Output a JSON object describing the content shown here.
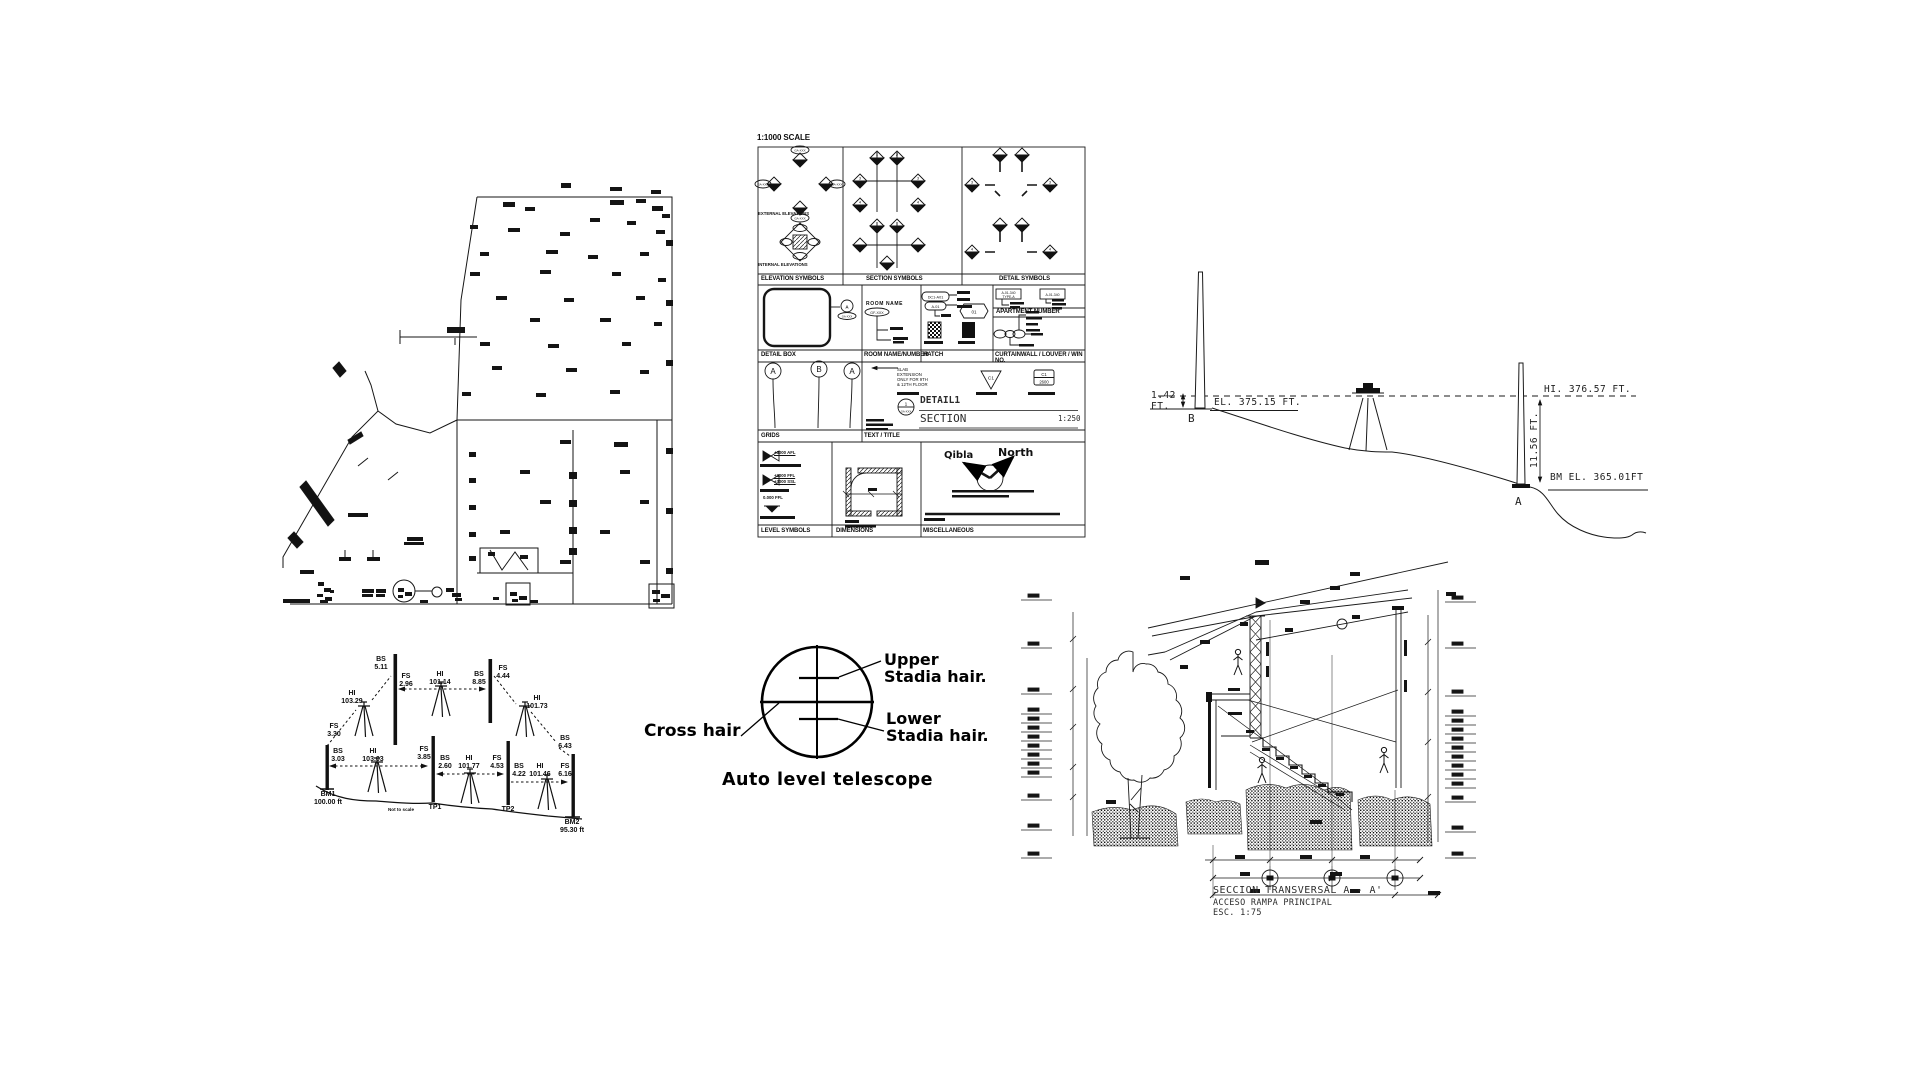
{
  "survey_profile": {
    "reading_b_value": "1.42",
    "reading_b_unit": "FT.",
    "elevation_label": "EL. 375.15 FT.",
    "point_b": "B",
    "hi_label": "HI. 376.57 FT.",
    "reading_a": "11.56 FT.",
    "bm_label": "BM EL. 365.01FT",
    "point_a": "A"
  },
  "leveling": {
    "upper_route": {
      "r1": "FS\n3.30",
      "hi1": "HI\n103.29",
      "r2": "BS\n5.11",
      "r3": "FS\n2.96",
      "hi2": "HI\n101.14",
      "r4": "BS\n8.85",
      "r5": "FS\n4.44",
      "hi3": "HI\n101.73",
      "r6": "BS\n6.43"
    },
    "lower_route": {
      "r1": "BS\n3.03",
      "hi1": "HI\n103.03",
      "r2": "FS\n3.85",
      "r3": "BS\n2.60",
      "hi2": "HI\n101.77",
      "r4": "FS\n4.53",
      "r5": "BS\n4.22",
      "hi3": "HI\n101.46",
      "r6": "FS\n6.16"
    },
    "bm1": "BM1\n100.00 ft",
    "bm2": "BM2\n95.30 ft",
    "tp1": "TP1",
    "tp2": "TP2",
    "note": "Not to scale"
  },
  "telescope": {
    "upper": "Upper\nStadia hair.",
    "cross": "Cross hair",
    "lower": "Lower\nStadia hair.",
    "caption": "Auto level telescope"
  },
  "legend": {
    "title": "1:1000 SCALE",
    "captions": {
      "elevation": "ELEVATION SYMBOLS",
      "section": "SECTION SYMBOLS",
      "detail": "DETAIL SYMBOLS",
      "detail_box": "DETAIL BOX",
      "room": "ROOM NAME/NUMBER",
      "hatch": "HATCH",
      "apartment": "APARTMENT NUMBER",
      "curtainwall": "CURTAINWALL / LOUVER / WIN NO.",
      "grids": "GRIDS",
      "text_title": "TEXT / TITLE",
      "level": "LEVEL SYMBOLS",
      "dimensions": "DIMENSIONS",
      "misc": "MISCELLANEOUS"
    },
    "sub": {
      "external": "EXTERNAL ELEVATIONS",
      "internal": "INTERNAL ELEVATIONS",
      "room_name": "ROOM NAME",
      "room_tag": "GF-XXX",
      "zone_tag1": "DC1-A01",
      "zone_tag2": "A-01",
      "apt_tag": "A-01-340",
      "apt_type": "TYPE-A",
      "hex_tag": "GA-XXX",
      "hex_num": "01",
      "grid_a": "A",
      "grid_b": "B",
      "rev_tag": "C1",
      "cw_tag": "C1",
      "cw_num": "2600",
      "slab_note": "SLAB\nEXTENSION\nONLY FOR 9TH\n& 12TH FLOOR",
      "detail_num": "1",
      "detail_title": "DETAIL1",
      "section_title": "SECTION",
      "scale": "1:250",
      "qibla": "Qibla",
      "north": "North",
      "lvl1": "+3000 AFL",
      "lvl2": "+3000 FFL",
      "lvl3": "+3000 SSL",
      "lvl4": "0.000 FFL",
      "n1": "1",
      "n2": "2",
      "n3": "3",
      "n4": "4"
    }
  },
  "section_drawing": {
    "title": "SECCION TRANSVERSAL A - A'",
    "subtitle": "ACCESO RAMPA PRINCIPAL",
    "scale": "ESC. 1:75"
  }
}
